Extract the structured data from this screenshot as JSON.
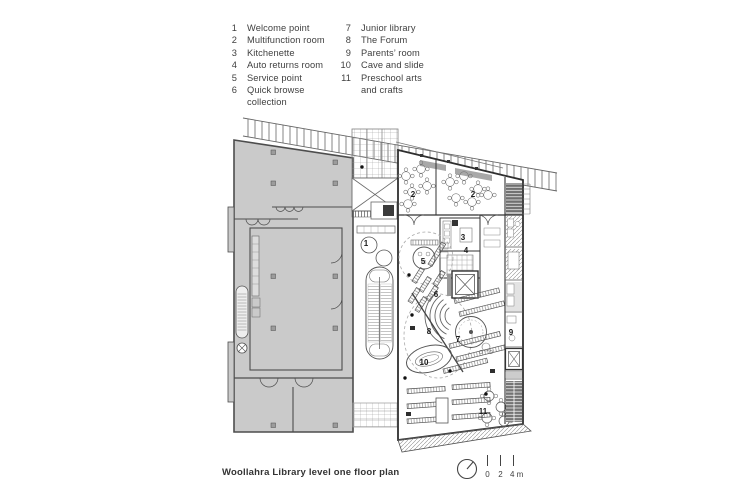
{
  "legend": {
    "columns": [
      {
        "items": [
          {
            "num": "1",
            "label": "Welcome point"
          },
          {
            "num": "2",
            "label": "Multifunction room"
          },
          {
            "num": "3",
            "label": "Kitchenette"
          },
          {
            "num": "4",
            "label": "Auto returns room"
          },
          {
            "num": "5",
            "label": "Service point"
          },
          {
            "num": "6",
            "label": "Quick browse\ncollection"
          }
        ]
      },
      {
        "items": [
          {
            "num": "7",
            "label": "Junior library"
          },
          {
            "num": "8",
            "label": "The Forum"
          },
          {
            "num": "9",
            "label": "Parents’ room"
          },
          {
            "num": "10",
            "label": "Cave and slide"
          },
          {
            "num": "11",
            "label": "Preschool arts\nand crafts"
          }
        ]
      }
    ]
  },
  "plan": {
    "room_labels": [
      "1",
      "2",
      "2",
      "3",
      "4",
      "5",
      "6",
      "7",
      "8",
      "9",
      "10",
      "11"
    ]
  },
  "caption": "Woollahra Library level one floor plan",
  "scale_bar": {
    "labels": [
      "0",
      "2",
      "4 m"
    ]
  },
  "colors": {
    "building_fill": "#cacaca",
    "wall_line": "#4d4d4d",
    "library_line": "#2f2f2f",
    "text": "#3f3f3f"
  }
}
